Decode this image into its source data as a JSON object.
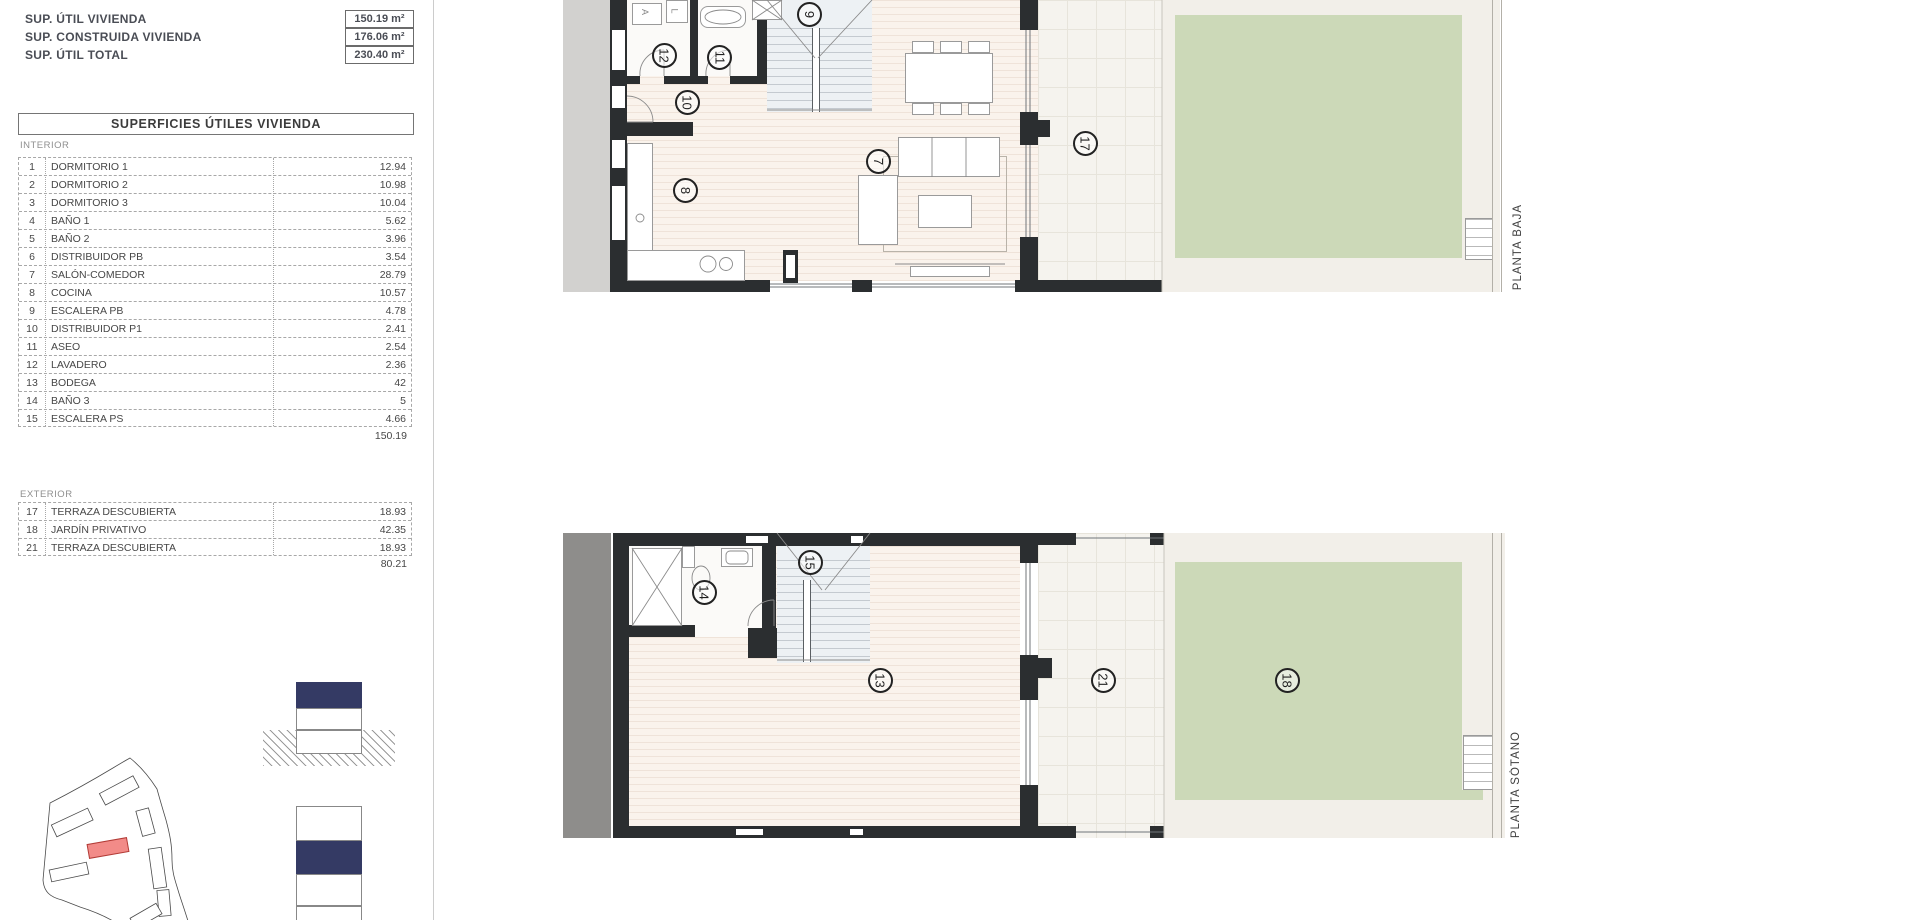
{
  "summary": {
    "rows": [
      {
        "label": "SUP. ÚTIL VIVIENDA",
        "value": "150.19 m²"
      },
      {
        "label": "SUP. CONSTRUIDA VIVIENDA",
        "value": "176.06 m²"
      },
      {
        "label": "SUP. ÚTIL TOTAL",
        "value": "230.40 m²"
      }
    ]
  },
  "table": {
    "title": "SUPERFICIES ÚTILES VIVIENDA",
    "interior_label": "INTERIOR",
    "exterior_label": "EXTERIOR",
    "interior_rows": [
      {
        "num": "1",
        "name": "DORMITORIO 1",
        "value": "12.94"
      },
      {
        "num": "2",
        "name": "DORMITORIO 2",
        "value": "10.98"
      },
      {
        "num": "3",
        "name": "DORMITORIO 3",
        "value": "10.04"
      },
      {
        "num": "4",
        "name": "BAÑO 1",
        "value": "5.62"
      },
      {
        "num": "5",
        "name": "BAÑO 2",
        "value": "3.96"
      },
      {
        "num": "6",
        "name": "DISTRIBUIDOR PB",
        "value": "3.54"
      },
      {
        "num": "7",
        "name": "SALÓN-COMEDOR",
        "value": "28.79"
      },
      {
        "num": "8",
        "name": "COCINA",
        "value": "10.57"
      },
      {
        "num": "9",
        "name": "ESCALERA PB",
        "value": "4.78"
      },
      {
        "num": "10",
        "name": "DISTRIBUIDOR P1",
        "value": "2.41"
      },
      {
        "num": "11",
        "name": "ASEO",
        "value": "2.54"
      },
      {
        "num": "12",
        "name": "LAVADERO",
        "value": "2.36"
      },
      {
        "num": "13",
        "name": "BODEGA",
        "value": "42"
      },
      {
        "num": "14",
        "name": "BAÑO 3",
        "value": "5"
      },
      {
        "num": "15",
        "name": "ESCALERA PS",
        "value": "4.66"
      }
    ],
    "interior_total": "150.19",
    "exterior_rows": [
      {
        "num": "17",
        "name": "TERRAZA DESCUBIERTA",
        "value": "18.93"
      },
      {
        "num": "18",
        "name": "JARDÍN PRIVATIVO",
        "value": "42.35"
      },
      {
        "num": "21",
        "name": "TERRAZA DESCUBIERTA",
        "value": "18.93"
      }
    ],
    "exterior_total": "80.21"
  },
  "plans": {
    "baja": {
      "label": "PLANTA BAJA",
      "closet_a": "A",
      "closet_l": "L",
      "circles": {
        "stair": "9",
        "laundry": "12",
        "aseo": "11",
        "hall": "10",
        "kitchen": "8",
        "living": "7",
        "terrace": "17"
      }
    },
    "sotano": {
      "label": "PLANTA SÓTANO",
      "circles": {
        "stair": "15",
        "bath": "14",
        "bodega": "13",
        "patio": "21",
        "garden": "18"
      }
    }
  },
  "colors": {
    "wall": "#2b2e30",
    "floor": "#faf3ec",
    "garden_green": "#ccd9b8",
    "locator_navy": "#343a64",
    "site_highlight": "#f28b88"
  }
}
